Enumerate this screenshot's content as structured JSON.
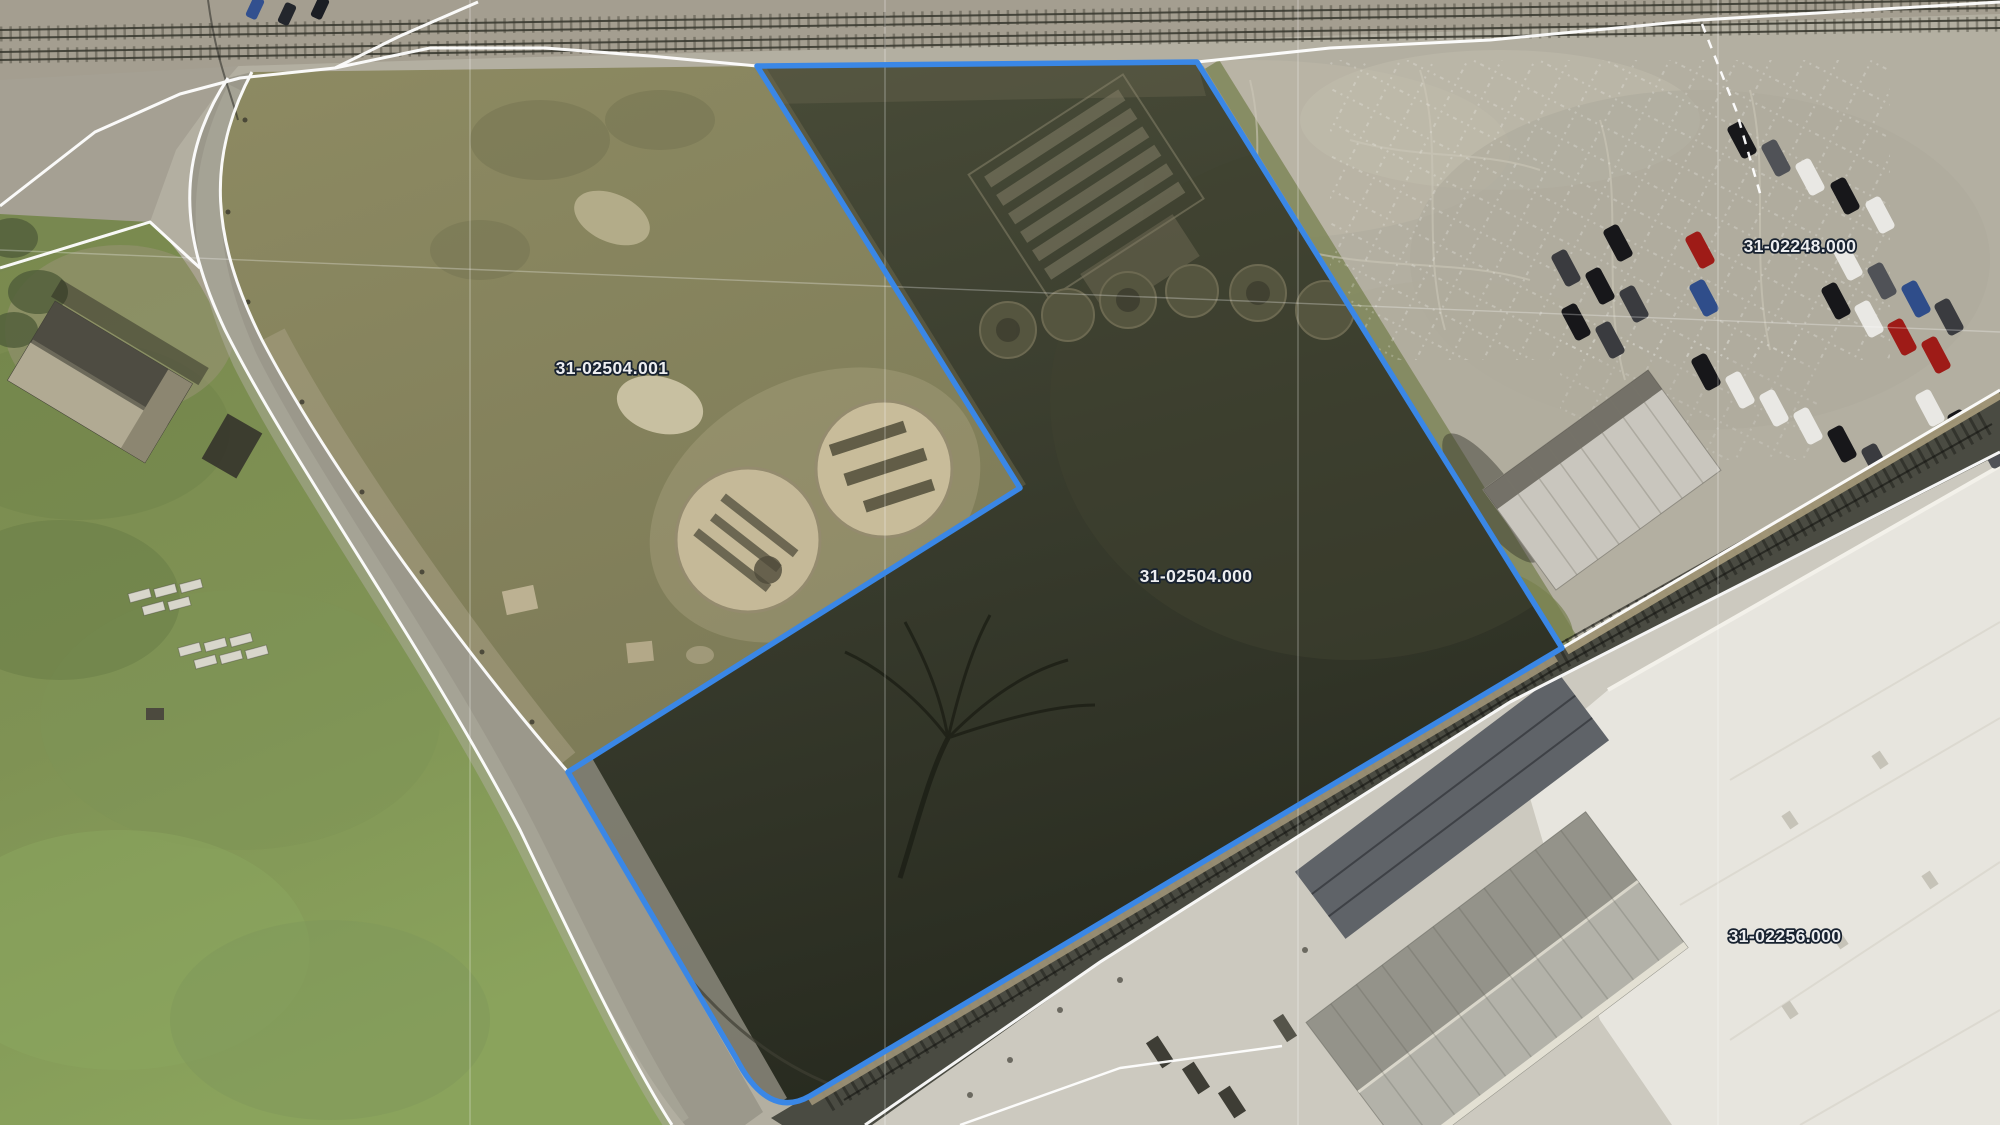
{
  "map": {
    "kind": "county GIS aerial parcel map",
    "selected_parcel_id": "31-02504.000",
    "parcels": [
      {
        "id": "31-02504.001"
      },
      {
        "id": "31-02504.000"
      },
      {
        "id": "31-02248.000"
      },
      {
        "id": "31-02256.000"
      }
    ],
    "colors": {
      "selected_outline": "#3a87e6",
      "parcel_line": "#ffffff",
      "label_fill": "#edeef0",
      "label_halo": "#182230",
      "grid_line": "rgba(255,255,255,0.28)"
    }
  }
}
